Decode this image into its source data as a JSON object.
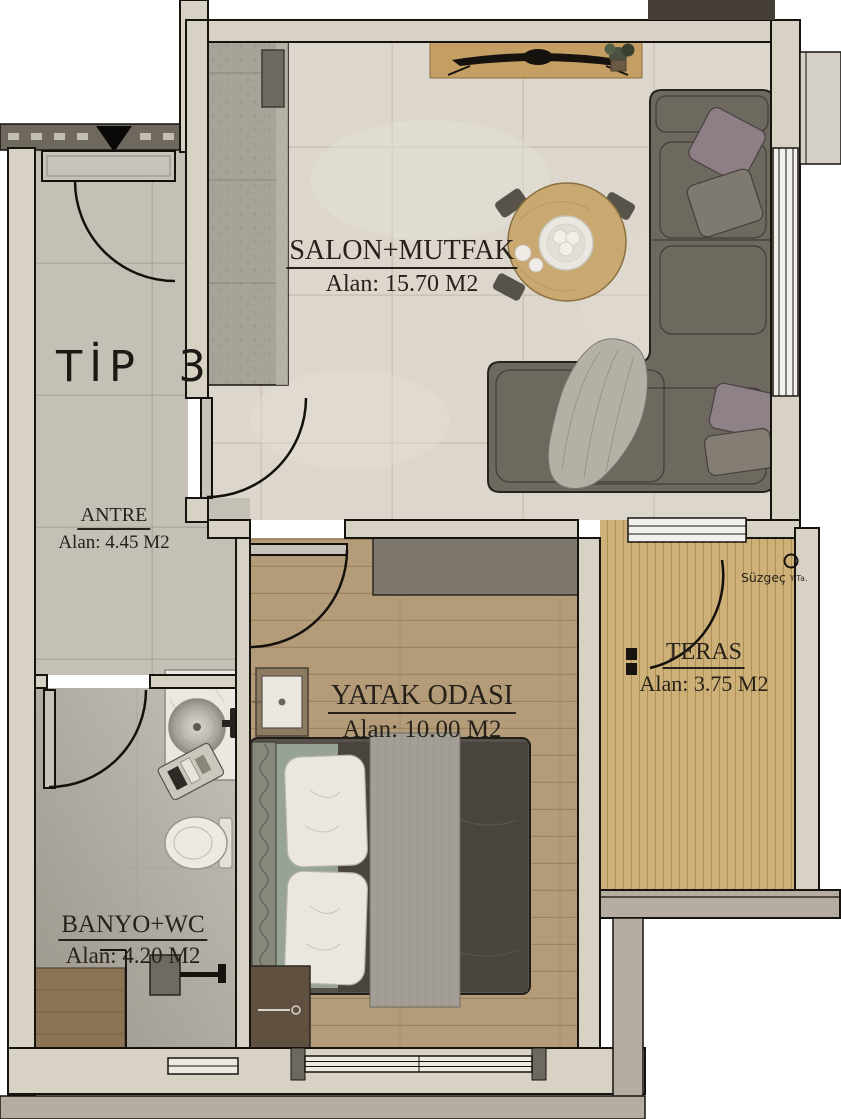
{
  "title": "TİP 3",
  "rooms": {
    "salon": {
      "name": "SALON+MUTFAK",
      "area": "Alan: 15.70 M2"
    },
    "antre": {
      "name": "ANTRE",
      "area": "Alan: 4.45 M2"
    },
    "yatak": {
      "name": "YATAK ODASI",
      "area": "Alan: 10.00 M2"
    },
    "teras": {
      "name": "TERAS",
      "area": "Alan: 3.75 M2"
    },
    "banyo": {
      "name": "BANYO+WC",
      "area": "Alan: 4.20 M2"
    }
  },
  "annotations": {
    "suzgec": "Süzgeç",
    "suzgec_sub": "Y.Ta."
  },
  "colors": {
    "wall": "#d8d2c5",
    "outline": "#17130f",
    "salon_floor": "#dcd6cc",
    "antre_floor": "#c5c0b6",
    "bath_floor_light": "#c6c1b8",
    "bath_floor_dark": "#9b968c",
    "bedroom_floor": "#b49c79",
    "teras_floor": "#cdb178",
    "sofa": "#6e695f",
    "bed_duvet": "#49443d",
    "wood_accent": "#c49e63",
    "exterior_band": "#b5ada1",
    "corridor": "#6f685e"
  }
}
